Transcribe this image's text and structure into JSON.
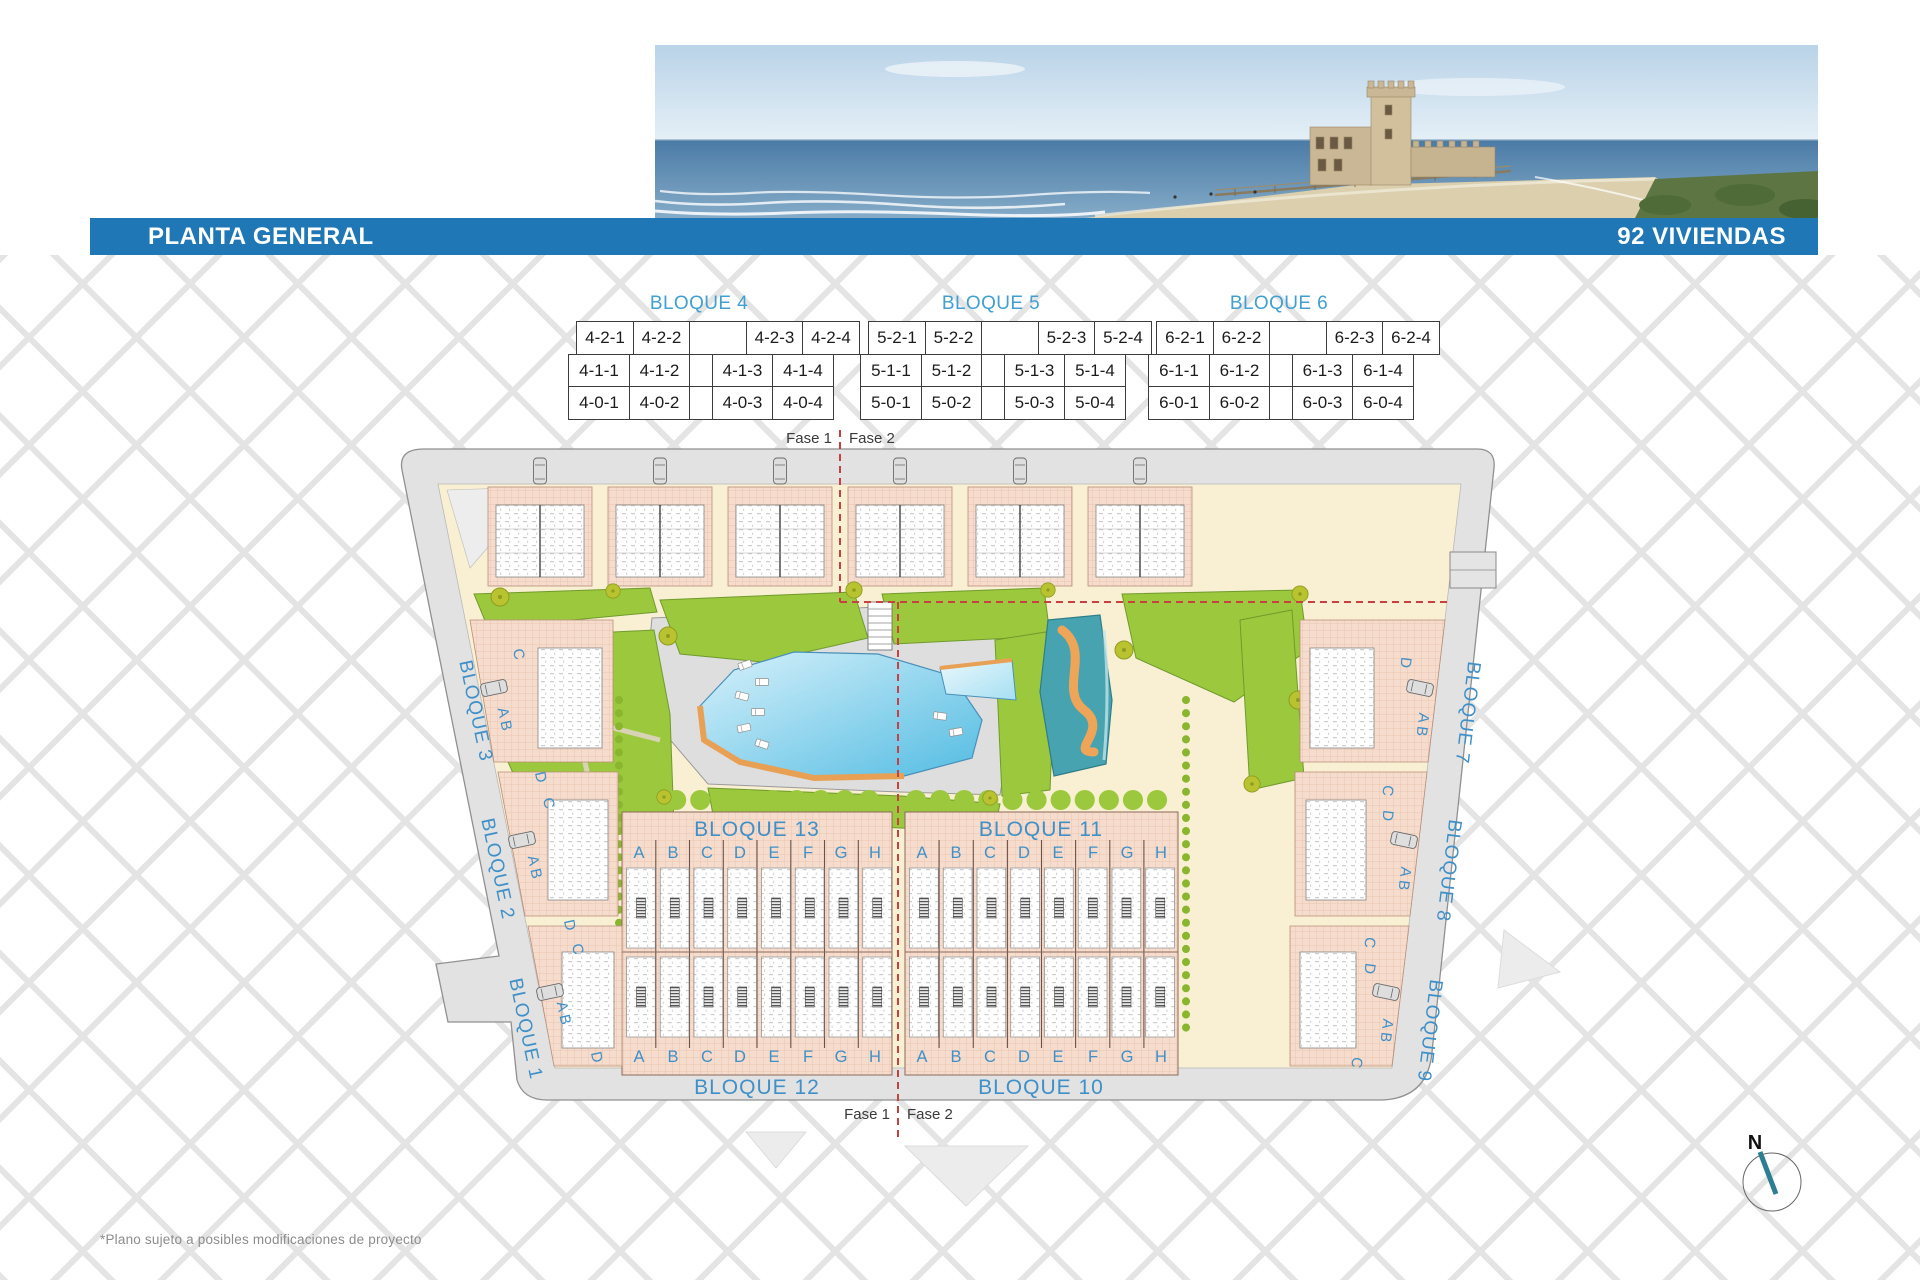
{
  "header": {
    "planta": "PLANTA GENERAL",
    "viviendas": "92 VIVIENDAS"
  },
  "tables": [
    {
      "title": "BLOQUE 4",
      "rows": [
        [
          "4-2-1",
          "4-2-2",
          "4-2-3",
          "4-2-4"
        ],
        [
          "4-1-1",
          "4-1-2",
          "4-1-3",
          "4-1-4"
        ],
        [
          "4-0-1",
          "4-0-2",
          "4-0-3",
          "4-0-4"
        ]
      ]
    },
    {
      "title": "BLOQUE 5",
      "rows": [
        [
          "5-2-1",
          "5-2-2",
          "5-2-3",
          "5-2-4"
        ],
        [
          "5-1-1",
          "5-1-2",
          "5-1-3",
          "5-1-4"
        ],
        [
          "5-0-1",
          "5-0-2",
          "5-0-3",
          "5-0-4"
        ]
      ]
    },
    {
      "title": "BLOQUE 6",
      "rows": [
        [
          "6-2-1",
          "6-2-2",
          "6-2-3",
          "6-2-4"
        ],
        [
          "6-1-1",
          "6-1-2",
          "6-1-3",
          "6-1-4"
        ],
        [
          "6-0-1",
          "6-0-2",
          "6-0-3",
          "6-0-4"
        ]
      ]
    }
  ],
  "plan": {
    "fase1": "Fase 1",
    "fase2": "Fase 2",
    "sections": {
      "b13": "BLOQUE 13",
      "b11": "BLOQUE 11",
      "b12": "BLOQUE 12",
      "b10": "BLOQUE 10",
      "letters": [
        "A",
        "B",
        "C",
        "D",
        "E",
        "F",
        "G",
        "H"
      ]
    },
    "left_blocks": [
      "BLOQUE 3",
      "BLOQUE 2",
      "BLOQUE 1"
    ],
    "right_blocks": [
      "BLOQUE 7",
      "BLOQUE 8",
      "BLOQUE 9"
    ],
    "left_letters": [
      "C",
      "A B",
      "D",
      "C",
      "A B",
      "D",
      "C",
      "A B",
      "D"
    ],
    "right_letters": [
      "D",
      "A B",
      "C",
      "D",
      "A B",
      "C",
      "D",
      "A B",
      "C"
    ],
    "compass": "N"
  },
  "footnote": "*Plano sujeto a posibles modificaciones de proyecto",
  "colors": {
    "header_blue": "#1f77b6",
    "label_blue": "#4090c8",
    "table_title_blue": "#42a0d0",
    "building_pink": "#f5dccd",
    "ground_cream": "#f9efd3",
    "road_gray": "#e2e2e2",
    "garden_green": "#9cc83d",
    "pool_blue": "#53bce2",
    "playground_teal": "#48a3b0",
    "path_orange": "#e8a054",
    "phase_red": "#c94040",
    "compass_teal": "#2c7e92"
  }
}
